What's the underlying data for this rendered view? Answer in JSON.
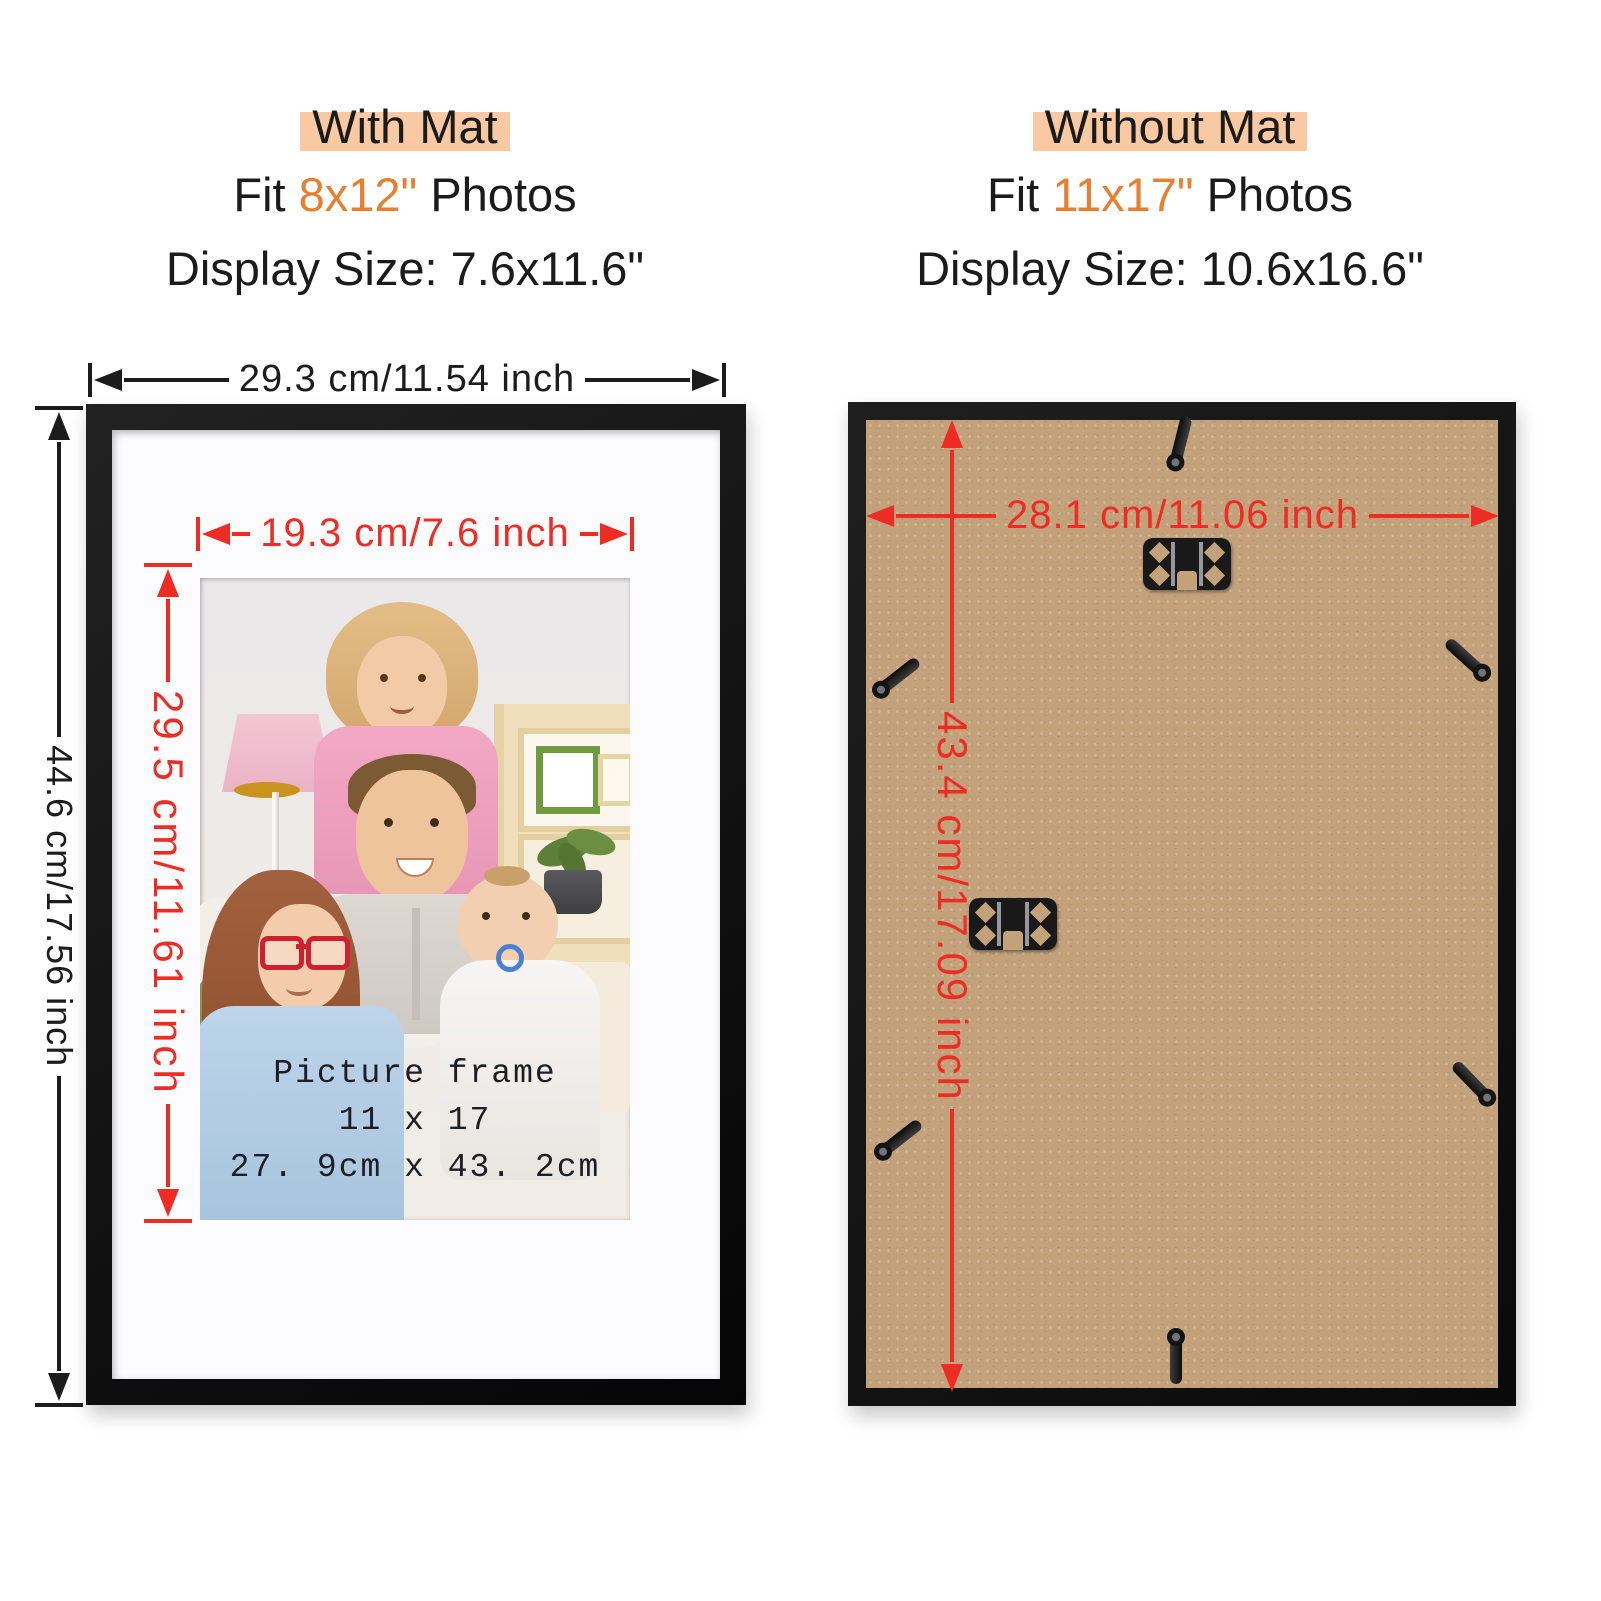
{
  "panels": {
    "left": {
      "title": "With Mat",
      "fit_prefix": "Fit",
      "fit_size": "8x12\"",
      "fit_suffix": "Photos",
      "display_size": "Display Size: 7.6x11.6\"",
      "outer_width_label": "29.3 cm/11.54 inch",
      "outer_height_label": "44.6 cm/17.56 inch",
      "opening_width_label": "19.3 cm/7.6 inch",
      "opening_height_label": "29.5 cm/11.61 inch",
      "photo_caption": [
        "Picture frame",
        "11 x 17",
        "27. 9cm x 43. 2cm"
      ]
    },
    "right": {
      "title": "Without Mat",
      "fit_prefix": "Fit",
      "fit_size": "11x17\"",
      "fit_suffix": "Photos",
      "display_size": "Display Size: 10.6x16.6\"",
      "board_width_label": "28.1 cm/11.06 inch",
      "board_height_label": "43.4 cm/17.09 inch"
    }
  },
  "colors": {
    "highlight_peach": "#f8c9a2",
    "accent_orange": "#e87f2e",
    "dimension_red": "#ee2c23",
    "dimension_black": "#1c1c1c",
    "frame_black": "#141414",
    "mat_white": "#fcfcfe",
    "board_tan": "#c3a17b"
  }
}
